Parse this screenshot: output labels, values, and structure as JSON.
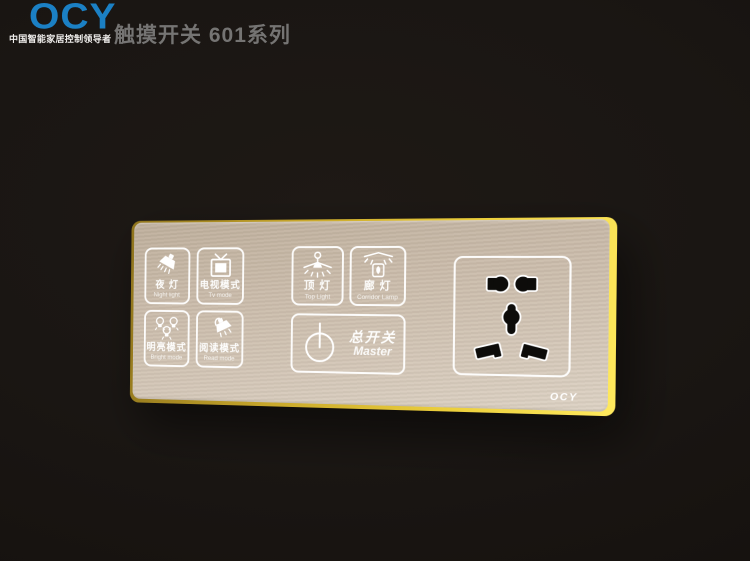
{
  "header": {
    "brand": "OCY",
    "tagline": "中国智能家居控制领导者",
    "title": "触摸开关 601系列"
  },
  "panel": {
    "brand_mark": "OCY",
    "buttons": [
      {
        "zh": "夜 灯",
        "en": "Night light"
      },
      {
        "zh": "电视模式",
        "en": "Tv mode"
      },
      {
        "zh": "明亮模式",
        "en": "Bright mode"
      },
      {
        "zh": "阅读模式",
        "en": "Read mode"
      },
      {
        "zh": "顶 灯",
        "en": "Top Light"
      },
      {
        "zh": "廊 灯",
        "en": "Corridor Lamp"
      },
      {
        "zh": "总开关",
        "en": "Master"
      }
    ],
    "socket": {
      "type": "5-hole universal power socket"
    },
    "colors": {
      "brand_blue": "#1b80c4",
      "panel_face": "#cfc1b0",
      "gold_edge": "#eccf3c",
      "line_white": "#ffffff",
      "background": "#1a1613"
    }
  }
}
